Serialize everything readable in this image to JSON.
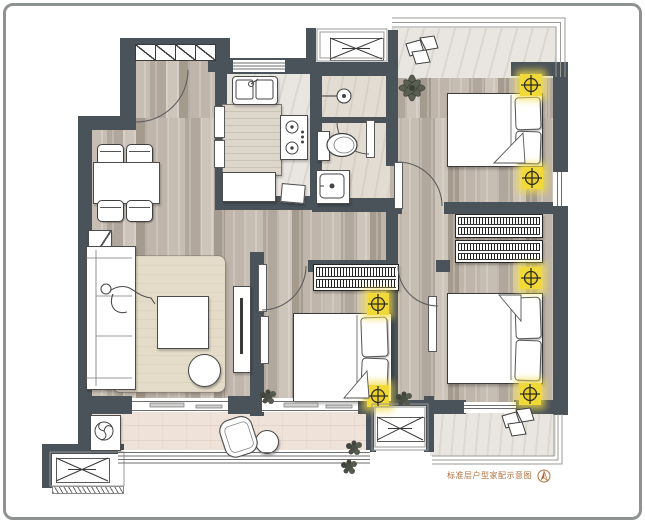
{
  "caption": {
    "text": "标准层户型家配示意图",
    "color": "#b0703f",
    "compass": "north-arrow-icon"
  },
  "palette": {
    "wall": "#4a525a",
    "wood_floor": "#b9afa4",
    "tile_floor": "#e9e6e1",
    "bath_floor": "#e3dcd3",
    "balcony_floor": "#eee2d9",
    "rug": "#e4dbc8",
    "island_counter": "#ddd6cb",
    "marker_yellow": "#f2d93a",
    "caption_text": "#b0703f"
  },
  "symbols": {
    "position_marker": {
      "icon": "crosshair-circle-icon",
      "count": 6,
      "color": "#f2d93a"
    },
    "ac_outdoor_unit": {
      "icon": "crossed-box-icon",
      "count": 3
    },
    "wardrobe": {
      "icon": "hatched-bar-icon",
      "count": 3
    },
    "entry_closet_sections": 4
  },
  "rooms": {
    "entry": {
      "items": [
        "shoe-closet",
        "entry-door-arc"
      ]
    },
    "dining": {
      "items": [
        "dining-table",
        "chair",
        "chair",
        "chair",
        "chair",
        "sideboard"
      ]
    },
    "kitchen": {
      "items": [
        "double-sink",
        "island-counter",
        "gas-stove",
        "fridge",
        "tray"
      ]
    },
    "bathroom": {
      "items": [
        "shower-head",
        "toilet",
        "wash-basin",
        "door"
      ]
    },
    "living": {
      "items": [
        "sofa",
        "person",
        "rug",
        "coffee-table",
        "pouf",
        "tv-cabinet",
        "side-table"
      ]
    },
    "bedroom_north": {
      "items": [
        "double-bed",
        "pillows",
        "flower-decor",
        "door"
      ]
    },
    "bedroom_middle": {
      "items": [
        "double-bed",
        "pillows",
        "wardrobe",
        "mirror",
        "door",
        "plant"
      ]
    },
    "bedroom_east": {
      "items": [
        "double-bed",
        "pillows",
        "wardrobe",
        "wardrobe",
        "mirror",
        "door",
        "plant"
      ]
    },
    "north_balcony": {
      "items": [
        "decorative-stones"
      ]
    },
    "south_balcony": {
      "items": [
        "washing-machine",
        "lounge-chair",
        "side-table",
        "plant",
        "sliding-glass"
      ]
    },
    "terrace": {
      "items": [
        "decorative-stones",
        "plant"
      ]
    }
  }
}
